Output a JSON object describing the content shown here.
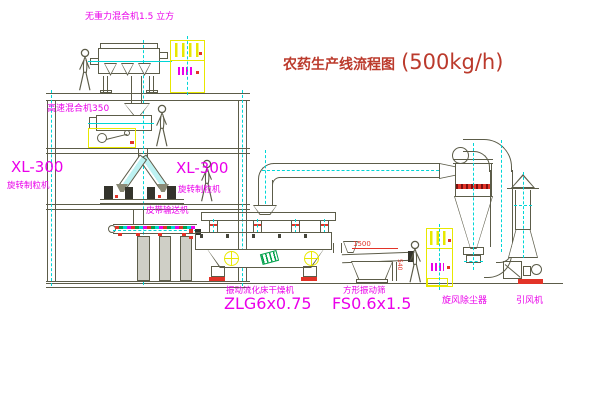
{
  "title": {
    "name": "农药生产线流程图",
    "capacity": "(500kg/h)"
  },
  "labels": {
    "gravity_mixer": "无重力混合机1.5 立方",
    "high_speed_mixer": "高速混合机350",
    "granulator_left_model": "XL-300",
    "granulator_left_name": "旋转制粒机",
    "granulator_right_model": "XL-300",
    "granulator_right_name": "旋转制粒机",
    "belt_conveyor": "皮带输送机",
    "dryer_name": "振动流化床干燥机",
    "dryer_model": "ZLG6x0.75",
    "sieve_name": "方形振动筛",
    "sieve_model": "FS0.6x1.5",
    "cyclone_name": "旋风除尘器",
    "fan_name": "引风机"
  },
  "dimensions": {
    "sieve_length": "1500",
    "sieve_height": "540"
  },
  "colors": {
    "label_magenta": "#ea00ea",
    "title_red": "#bb3a2c",
    "line_olive": "#5c5c49",
    "centerline_cyan": "#00d6d6",
    "highlight_yellow": "#e8e800",
    "accent_red": "#e23328",
    "logo_green": "#00a14b"
  }
}
